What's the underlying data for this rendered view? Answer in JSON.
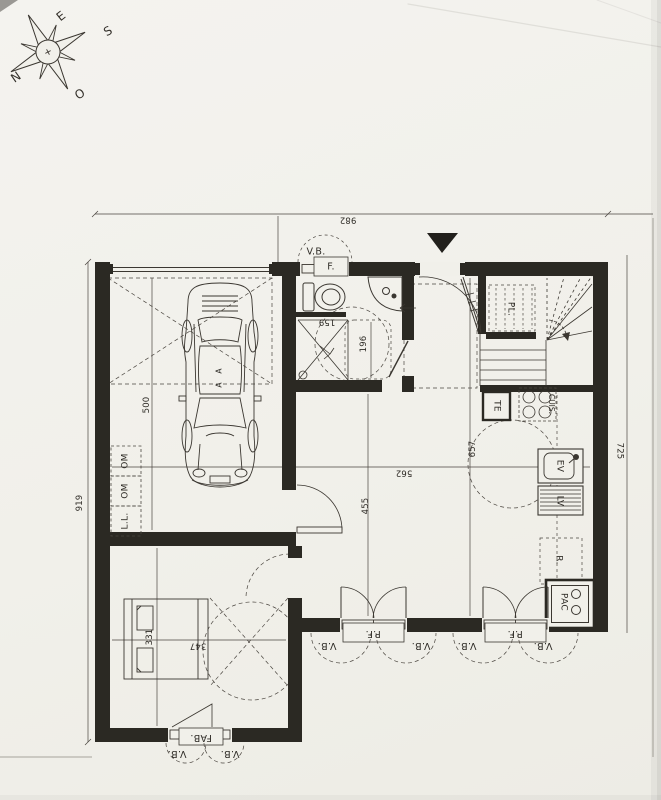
{
  "palette": {
    "paper": "#f1f0ea",
    "ink": "#3b3731",
    "wall": "#2b2923",
    "faint_line": "#8f8b83",
    "dim_line": "#4a453f"
  },
  "compass": {
    "north": "N",
    "south": "S",
    "east": "E",
    "west": "O"
  },
  "dimensions": {
    "overall_width": "982",
    "overall_left_height": "919",
    "right_height": "725",
    "garage_depth": "500",
    "living_length": "657",
    "living_width": "562",
    "living_partial_length": "455",
    "bedroom_length": "331",
    "bedroom_width": "347",
    "bath_width": "159",
    "bath_length": "196"
  },
  "openings": {
    "top_shutter": "V.B.",
    "top_window": "F.",
    "french_door_1": "P.F.",
    "french_door_2": "P.F.",
    "bottom_shutters": [
      "V.B.",
      "V.B.",
      "V.B.",
      "V.B."
    ],
    "bedroom_window": "FAB.",
    "bedroom_shutters": [
      "V.B.",
      "V.B."
    ]
  },
  "equipment": {
    "closet": "PL.",
    "electrical_panel": "TE",
    "hob": "CUIS.",
    "kitchen_sink": "EV",
    "dishwasher": "LV",
    "fridge": "R.",
    "heat_pump": "PAC",
    "bin_1": "OM",
    "bin_2": "OM",
    "washing_machine": "L.L.",
    "car_marks": [
      "A",
      "A"
    ]
  }
}
